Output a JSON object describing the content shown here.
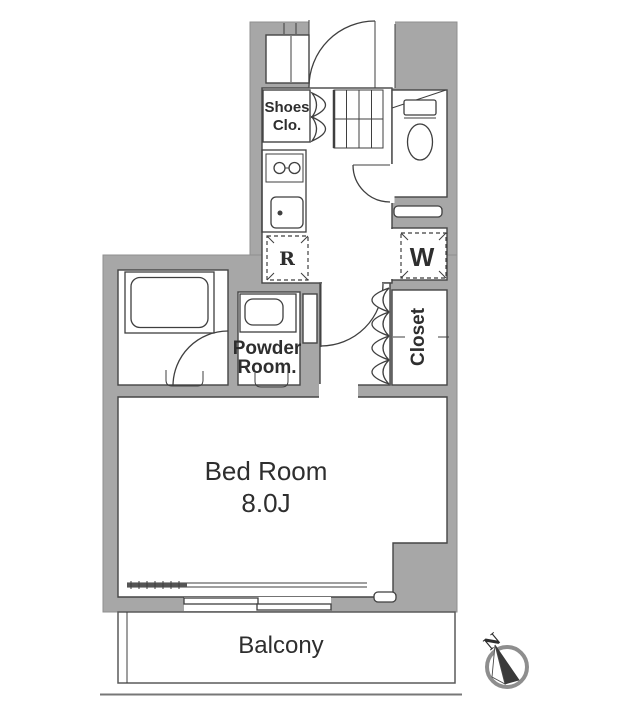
{
  "floorplan": {
    "rooms": {
      "shoes_closet": {
        "line1": "Shoes",
        "line2": "Clo."
      },
      "powder_room": {
        "line1": "Powder",
        "line2": "Room."
      },
      "closet": {
        "label": "Closet"
      },
      "bedroom": {
        "name": "Bed Room",
        "size": "8.0J"
      },
      "balcony": {
        "label": "Balcony"
      }
    },
    "appliances": {
      "refrigerator_mark": "R",
      "washer_mark": "W"
    },
    "compass": {
      "north_label": "N"
    },
    "colors": {
      "wall_fill": "#a7a7a7",
      "wall_outline": "#8f8f8f",
      "line": "#3f3f3f",
      "text": "#2e2e2e",
      "background": "#ffffff"
    }
  }
}
